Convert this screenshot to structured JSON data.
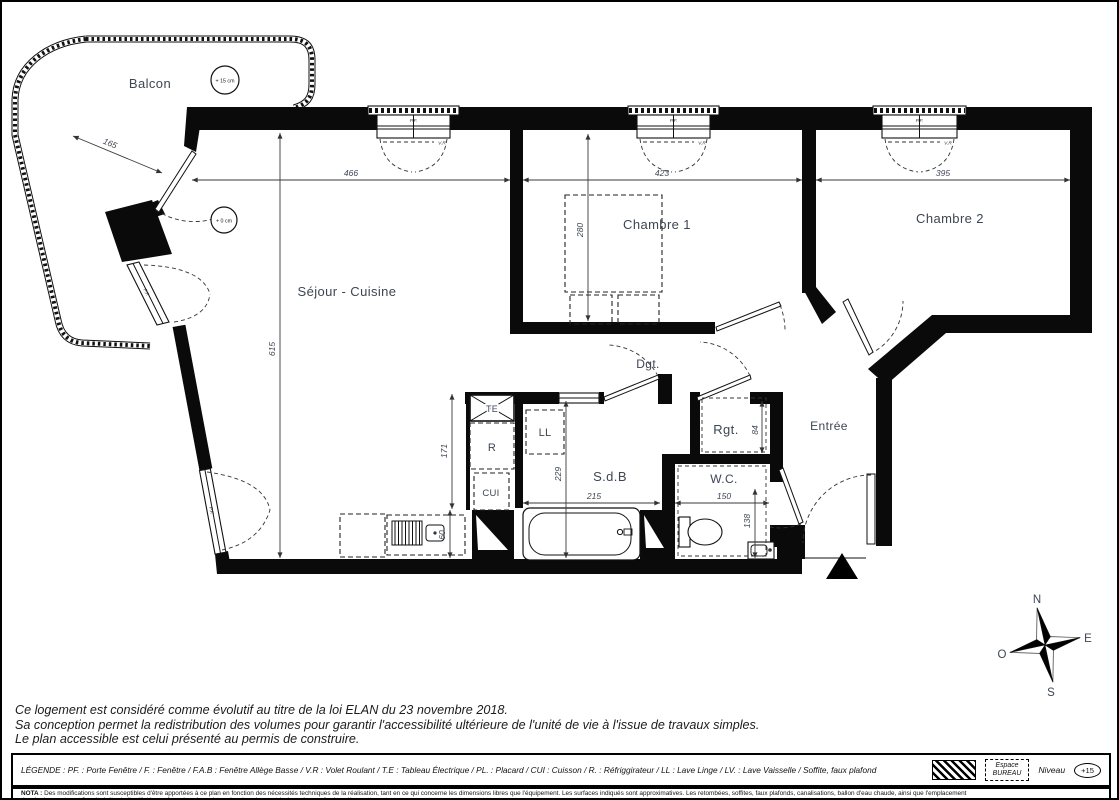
{
  "plan": {
    "rooms": {
      "balcon": "Balcon",
      "sejour": "Séjour - Cuisine",
      "chambre1": "Chambre 1",
      "chambre2": "Chambre 2",
      "dgt": "Dgt.",
      "sdb": "S.d.B",
      "wc": "W.C.",
      "rgt": "Rgt.",
      "entree": "Entrée"
    },
    "equipment": {
      "cui": "CUI",
      "refrigerator": "R",
      "lave_linge": "LL",
      "tableau_electrique": "TE"
    },
    "levels": {
      "balcon": "+ 15 cm",
      "sejour": "+ 0 cm"
    },
    "window_label": "P.F.",
    "volet_label": "V.R",
    "dimensions": {
      "sejour_width": "466",
      "chambre1_width": "423",
      "chambre2_width": "395",
      "sejour_height": "615",
      "chambre1_depth": "280",
      "balcon_width": "165",
      "kitchen_height": "171",
      "sdb_height": "229",
      "sdb_width": "215",
      "wc_width": "150",
      "wc_depth": "138",
      "rgt_depth": "84",
      "counter_depth": "60"
    },
    "compass": {
      "north": "N",
      "east": "E",
      "south": "S",
      "west": "O"
    }
  },
  "footer": {
    "notes": [
      "Ce logement est considéré comme évolutif au titre de la loi ELAN du 23 novembre 2018.",
      "Sa conception permet la redistribution des volumes pour garantir l'accessibilité ultérieure de l'unité de vie à l'issue de travaux simples.",
      "Le plan accessible est celui présenté au permis de construire."
    ],
    "legend_text": "LÉGENDE :   PF. : Porte Fenêtre   /   F. : Fenêtre   /   F.A.B : Fenêtre Allège Basse   /   V.R : Volet Roulant   /   T.E : Tableau Électrique   /   PL. : Placard   /   CUI : Cuisson   /   R. : Réfriggirateur   /   LL : Lave Linge   /   LV. : Lave Vaisselle   /   Soffite, faux plafond",
    "espace_line1": "Espace",
    "espace_line2": "BUREAU",
    "niveau_label": "Niveau",
    "niveau_value": "+15",
    "nota_label": "NOTA :",
    "nota_line1": "Des modifications sont susceptibles d'être apportées à ce plan en fonction des nécessités techniques de la réalisation, tant en ce qui concerne les dimensions libres que  l'équipement. Les surfaces indiqués sont approximatives. Les retombées, soffites, faux plafonds, canalisations, ballon d'eau chaude, ainsi que l'emplacement",
    "nota_line2": "des équipement sont figurés à titre indicatif. / La surface des placards ou des dressings est incluse dans celle des pièces attenantes."
  }
}
